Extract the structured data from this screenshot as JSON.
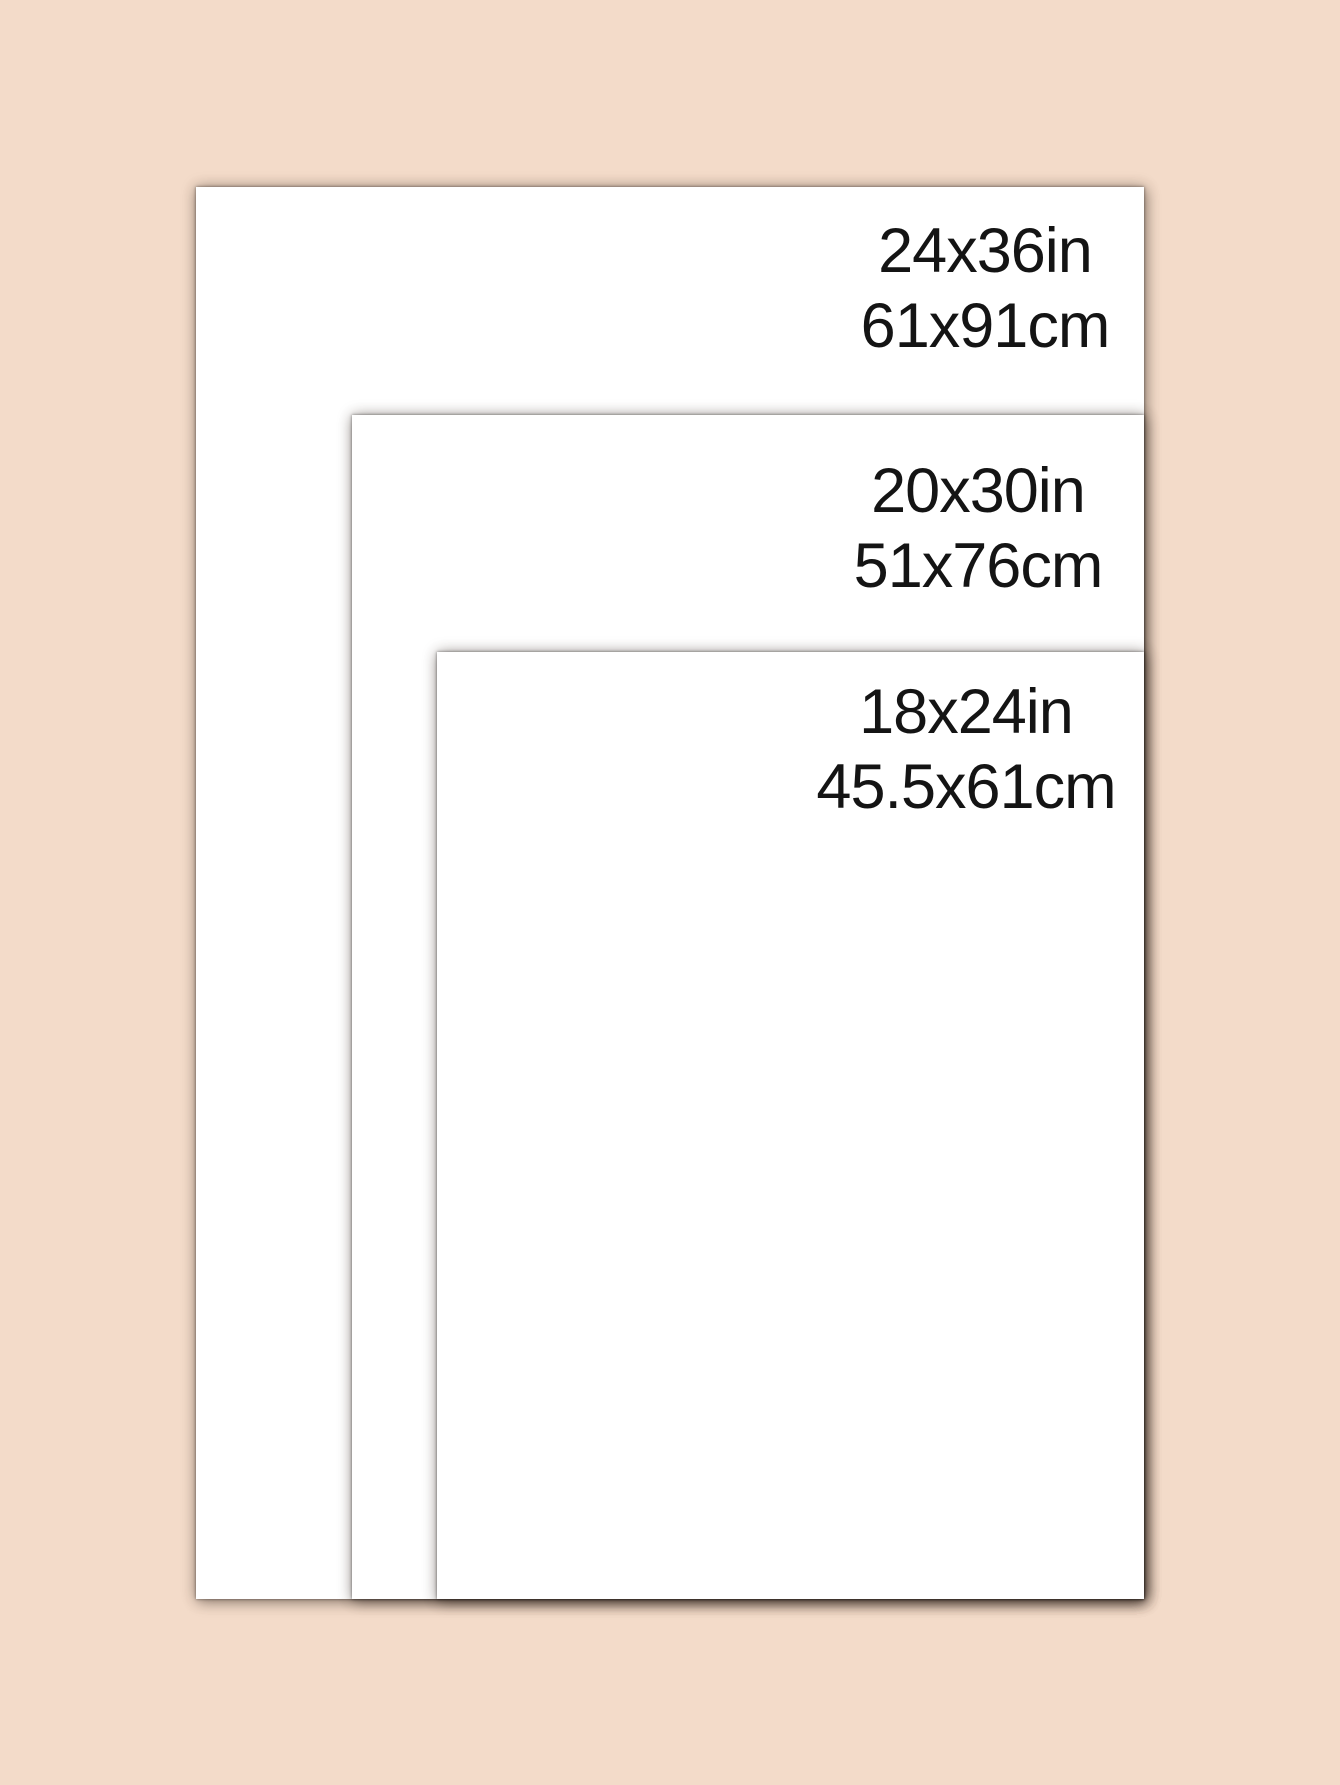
{
  "meta": {
    "description": "Poster print size comparison guide with three nested white sheets on a peach background",
    "background_color": "#f3dbc9",
    "sheet_color": "#ffffff",
    "text_color": "#141414"
  },
  "sizes": [
    {
      "name": "24x36",
      "inches": "24x36in",
      "centimeters": "61x91cm"
    },
    {
      "name": "20x30",
      "inches": "20x30in",
      "centimeters": "51x76cm"
    },
    {
      "name": "18x24",
      "inches": "18x24in",
      "centimeters": "45.5x61cm"
    }
  ]
}
